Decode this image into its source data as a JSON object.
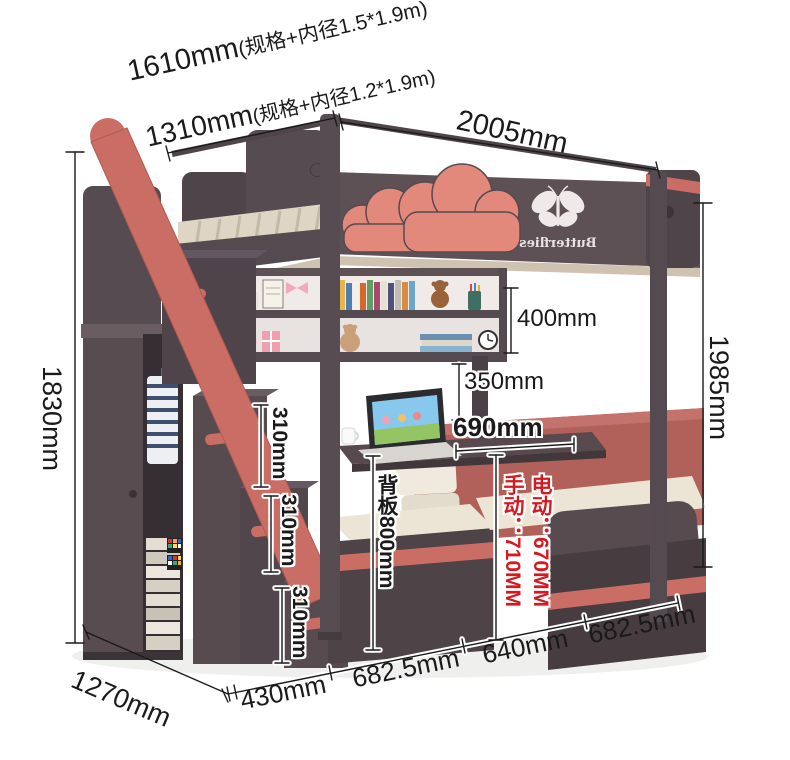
{
  "colors": {
    "dim_text": "#1a1a1a",
    "red_dim_text": "#d41920",
    "panel_dark": "#574b50",
    "accent_pink": "#e2897c",
    "accent_red": "#ca6e65",
    "backboard_red": "#b2615a",
    "mattress_cream": "#ece5d6",
    "outline_white": "#ffffff"
  },
  "labels": {
    "spec_large": {
      "value": "1610mm",
      "note": "(规格+内径1.5*1.9m)"
    },
    "spec_small": {
      "value": "1310mm",
      "note": "(规格+内径1.2*1.9m)"
    },
    "total_width": "2005mm",
    "left_height": "1830mm",
    "right_height": "1985mm",
    "shelf_height": "400mm",
    "desk_clearance": "350mm",
    "desk_width": "690mm",
    "step_height_1": "310mm",
    "step_height_2": "310mm",
    "step_height_3": "310mm",
    "backboard_height": "背板800mm",
    "desk_lift_electric": "电动：670MM",
    "desk_lift_manual": "手动：710MM",
    "depth": "1270mm",
    "bottom_seg_1": "430mm",
    "bottom_seg_2": "682.5mm",
    "bottom_seg_3": "640mm",
    "bottom_seg_4": "682.5mm"
  },
  "decor": {
    "brand": "Butterflies"
  }
}
